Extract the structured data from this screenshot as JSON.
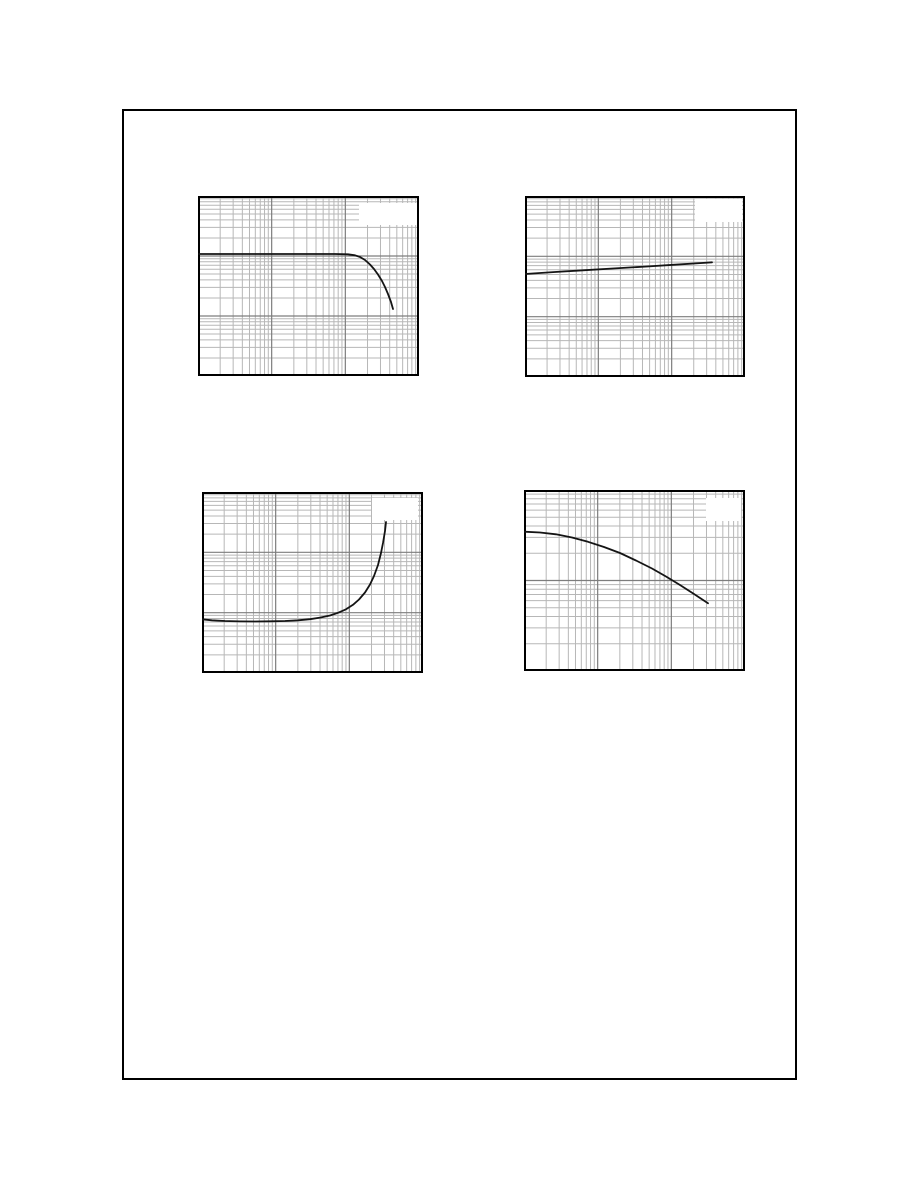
{
  "page": {
    "width": 918,
    "height": 1188,
    "background": "#ffffff",
    "border": {
      "x": 122,
      "y": 109,
      "w": 675,
      "h": 971,
      "color": "#000000",
      "thickness": 2
    }
  },
  "grid_style": {
    "minor_color": "#b7b7b7",
    "major_color": "#7d7d7d",
    "frame_color": "#000000",
    "curve_color": "#141414",
    "legend_fill": "#ffffff"
  },
  "charts": [
    {
      "id": "chart-1",
      "position": "top-left",
      "frame": {
        "x": 198,
        "y": 196,
        "w": 221,
        "h": 180
      },
      "x_decades": 3,
      "y_decades": 3,
      "legend_box": {
        "x": 359,
        "y": 203,
        "w": 58,
        "h": 22
      },
      "curve_px": [
        [
          199,
          254
        ],
        [
          240,
          254
        ],
        [
          280,
          254
        ],
        [
          310,
          254
        ],
        [
          335,
          254
        ],
        [
          348,
          254.3
        ],
        [
          355,
          255.3
        ],
        [
          360,
          257
        ],
        [
          365,
          260
        ],
        [
          370,
          264.5
        ],
        [
          374,
          269
        ],
        [
          378,
          274.5
        ],
        [
          382,
          281
        ],
        [
          385,
          287
        ],
        [
          388,
          294
        ],
        [
          391,
          302
        ],
        [
          393,
          309
        ]
      ]
    },
    {
      "id": "chart-2",
      "position": "top-right",
      "frame": {
        "x": 525,
        "y": 196,
        "w": 220,
        "h": 181
      },
      "x_decades": 3,
      "y_decades": 3,
      "legend_box": {
        "x": 695,
        "y": 199,
        "w": 47,
        "h": 23
      },
      "curve_px": [
        [
          525,
          274
        ],
        [
          555,
          272
        ],
        [
          585,
          270.2
        ],
        [
          615,
          268.4
        ],
        [
          645,
          266.6
        ],
        [
          675,
          264.7
        ],
        [
          700,
          263.1
        ],
        [
          712,
          262.3
        ]
      ]
    },
    {
      "id": "chart-3",
      "position": "bottom-left",
      "frame": {
        "x": 202,
        "y": 492,
        "w": 221,
        "h": 181
      },
      "x_decades": 3,
      "y_decades": 3,
      "legend_box": {
        "x": 372,
        "y": 498,
        "w": 46,
        "h": 22
      },
      "curve_px": [
        [
          202,
          619.3
        ],
        [
          212,
          620.3
        ],
        [
          225,
          621
        ],
        [
          240,
          621.4
        ],
        [
          255,
          621.5
        ],
        [
          270,
          621.3
        ],
        [
          285,
          621
        ],
        [
          298,
          620.3
        ],
        [
          310,
          619.2
        ],
        [
          320,
          617.6
        ],
        [
          330,
          615.5
        ],
        [
          338,
          612.8
        ],
        [
          346,
          609.3
        ],
        [
          353,
          604.8
        ],
        [
          359,
          599.5
        ],
        [
          365,
          592.5
        ],
        [
          370,
          584.5
        ],
        [
          374,
          576
        ],
        [
          378,
          565
        ],
        [
          381,
          553
        ],
        [
          383,
          543
        ],
        [
          385,
          531
        ],
        [
          386,
          522
        ]
      ]
    },
    {
      "id": "chart-4",
      "position": "bottom-right",
      "frame": {
        "x": 524,
        "y": 490,
        "w": 221,
        "h": 181
      },
      "x_decades": 3,
      "y_decades": 2,
      "legend_box": {
        "x": 706,
        "y": 498,
        "w": 35,
        "h": 23
      },
      "curve_px": [
        [
          524,
          531.7
        ],
        [
          540,
          532.5
        ],
        [
          556,
          534.3
        ],
        [
          572,
          537.5
        ],
        [
          588,
          541.8
        ],
        [
          604,
          547
        ],
        [
          620,
          553
        ],
        [
          636,
          560.5
        ],
        [
          652,
          568.5
        ],
        [
          666,
          576.5
        ],
        [
          680,
          585
        ],
        [
          694,
          594
        ],
        [
          708,
          603.3
        ]
      ]
    }
  ],
  "chart_data": [
    {
      "id": "top-left",
      "type": "line",
      "title": "",
      "xlabel": "",
      "ylabel": "",
      "x_scale": "log",
      "y_scale": "log",
      "x_range_decades": 3,
      "y_range_decades": 3,
      "tick_labels_visible": false,
      "legend_visible": true,
      "legend_text_legible": false,
      "legend_position": "top-right",
      "grid": "log-log, minor lines 2-9 per decade",
      "series": [
        {
          "name": "curve",
          "x": [
            1,
            50,
            109,
            135,
            158,
            216,
            295,
            368,
            444
          ],
          "y": [
            108,
            108,
            107,
            104,
            96,
            72,
            49,
            26,
            13
          ]
        }
      ],
      "units_note": "axes unlabeled in scan; values normalized with 1 at bottom-left decade line"
    },
    {
      "id": "top-right",
      "type": "line",
      "title": "",
      "xlabel": "",
      "ylabel": "",
      "x_scale": "log",
      "y_scale": "log",
      "x_range_decades": 3,
      "y_range_decades": 3,
      "tick_labels_visible": false,
      "legend_visible": true,
      "legend_text_legible": false,
      "legend_position": "top-right",
      "grid": "log-log, minor lines 2-9 per decade",
      "series": [
        {
          "name": "curve",
          "x": [
            1,
            2.6,
            6.6,
            17,
            43,
            111,
            243,
            355
          ],
          "y": [
            51,
            55,
            58,
            63,
            67,
            72,
            77,
            79
          ]
        }
      ],
      "units_note": "axes unlabeled in scan; values normalized with 1 at bottom-left decade line"
    },
    {
      "id": "bottom-left",
      "type": "line",
      "title": "",
      "xlabel": "",
      "ylabel": "",
      "x_scale": "log",
      "y_scale": "log",
      "x_range_decades": 3,
      "y_range_decades": 3,
      "tick_labels_visible": false,
      "legend_visible": true,
      "legend_text_legible": false,
      "legend_position": "top-right",
      "grid": "log-log, minor lines 2-9 per decade",
      "series": [
        {
          "name": "curve",
          "x": [
            1,
            4.5,
            13,
            29,
            55,
            90,
            135,
            190,
            245,
            286,
            315
          ],
          "y": [
            7.8,
            7.1,
            7.3,
            7.8,
            9,
            11.4,
            16.5,
            29,
            62,
            143,
            318
          ]
        }
      ],
      "units_note": "axes unlabeled in scan; values normalized with 1 at bottom-left decade line"
    },
    {
      "id": "bottom-right",
      "type": "line",
      "title": "",
      "xlabel": "",
      "ylabel": "",
      "x_scale": "log",
      "y_scale": "log",
      "x_range_decades": 3,
      "y_range_decades": 2,
      "tick_labels_visible": false,
      "legend_visible": true,
      "legend_text_legible": false,
      "legend_position": "top-right",
      "grid": "log-log, minor lines 2-9 per decade",
      "series": [
        {
          "name": "curve",
          "x": [
            1,
            2.7,
            7.4,
            20,
            55,
            131,
            314
          ],
          "y": [
            35,
            33,
            27,
            20,
            14,
            9,
            5.7
          ]
        }
      ],
      "units_note": "axes unlabeled in scan; values normalized with 1 at bottom-left decade line"
    }
  ]
}
